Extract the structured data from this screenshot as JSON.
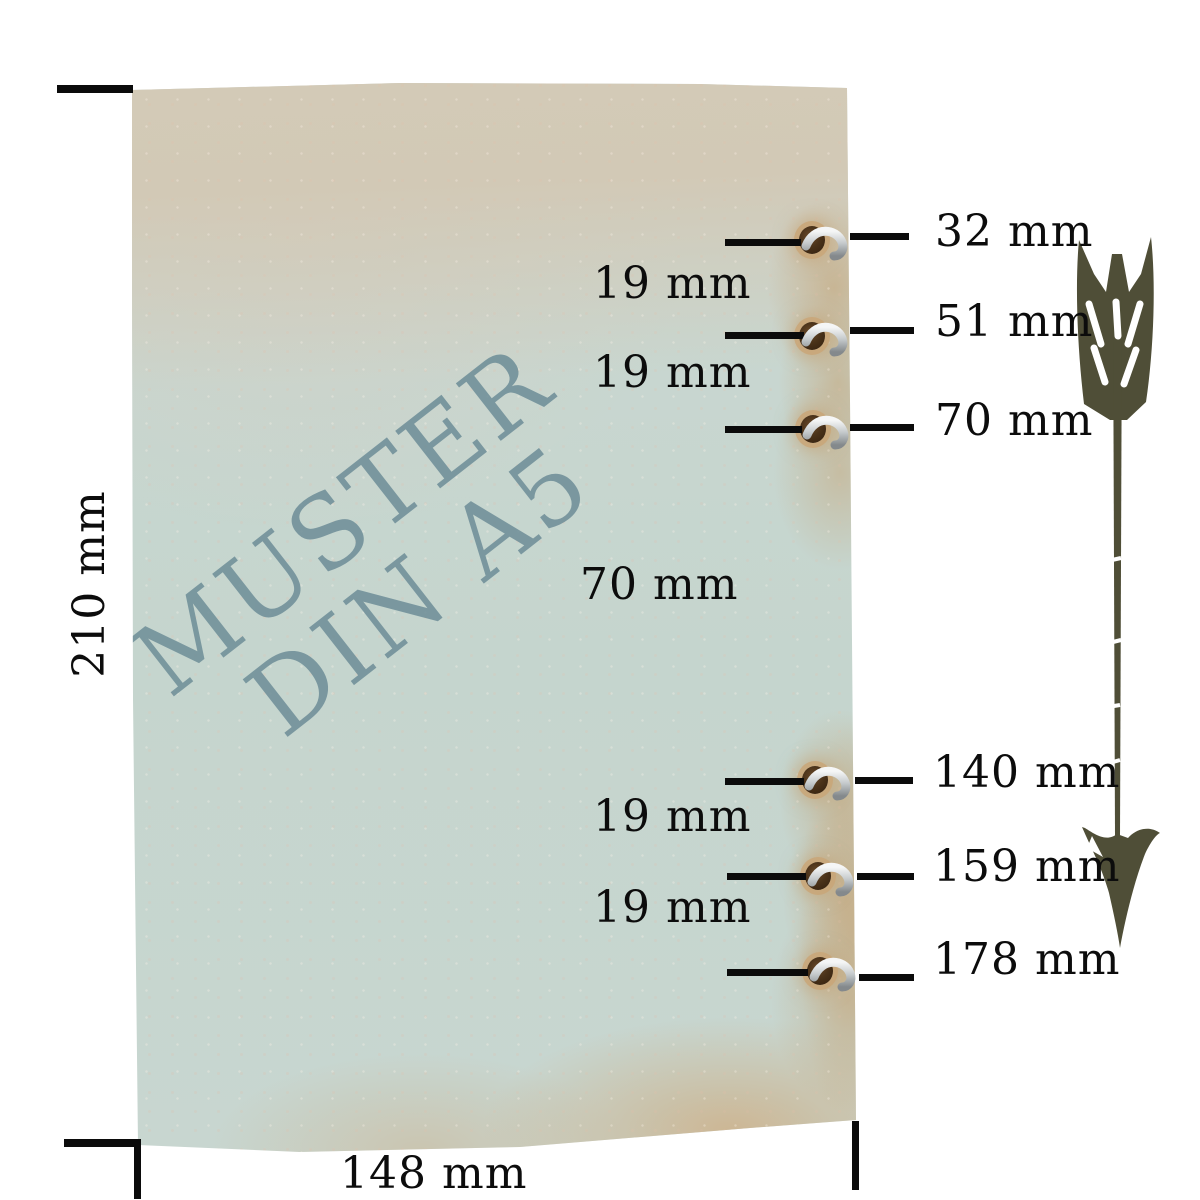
{
  "watermark": {
    "line1": "MUSTER",
    "line2": "DIN A5"
  },
  "page_dimensions": {
    "height": "210 mm",
    "width": "148 mm"
  },
  "holes": [
    {
      "label": "32 mm"
    },
    {
      "label": "51 mm"
    },
    {
      "label": "70 mm"
    },
    {
      "label": "140 mm"
    },
    {
      "label": "159 mm"
    },
    {
      "label": "178 mm"
    }
  ],
  "spacings": [
    {
      "label": "19 mm"
    },
    {
      "label": "19 mm"
    },
    {
      "label": "70 mm"
    },
    {
      "label": "19 mm"
    },
    {
      "label": "19 mm"
    }
  ],
  "icons": {
    "arrow": "feather-arrow-down",
    "rings": "binder-ring"
  },
  "colors": {
    "paper_blue": "#c6d5cf",
    "paper_tan": "#d3cab7",
    "stain_tan": "#c29e6f",
    "watermark": "#6d8d97",
    "line": "#0b0b0b",
    "arrow": "#4f4e37",
    "ring_silver": "#c9cccd"
  }
}
